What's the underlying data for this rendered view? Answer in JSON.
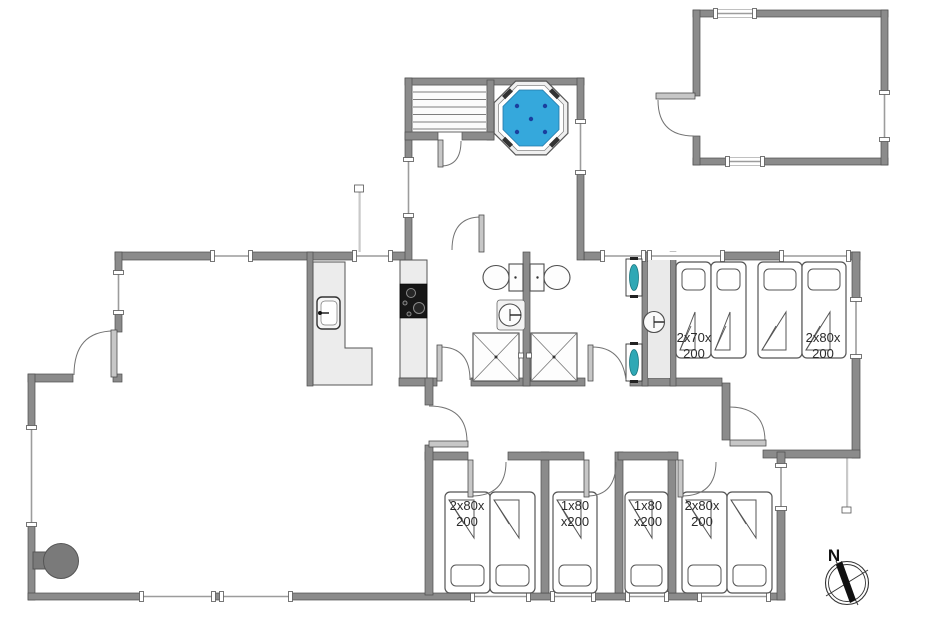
{
  "compass": {
    "north_label": "N"
  },
  "rooms": {
    "bed_labels": {
      "top_a": {
        "line1": "2x70x",
        "line2": "200"
      },
      "top_b": {
        "line1": "2x80x",
        "line2": "200"
      },
      "bottom_1": {
        "line1": "2x80x",
        "line2": "200"
      },
      "bottom_2": {
        "line1": "1x80",
        "line2": "x200"
      },
      "bottom_3": {
        "line1": "1x80",
        "line2": "x200"
      },
      "bottom_4": {
        "line1": "2x80x",
        "line2": "200"
      }
    }
  },
  "colors": {
    "wall": "#8b8b8b",
    "hot_tub_water": "#35a8dc",
    "hot_tub_jet": "#1a3f9e",
    "counter": "#ececec",
    "cooktop": "#161616",
    "wood_stove": "#7a7a7a",
    "vent_unit_teal": "#2fa8b5",
    "compass_needle": "#111111"
  }
}
